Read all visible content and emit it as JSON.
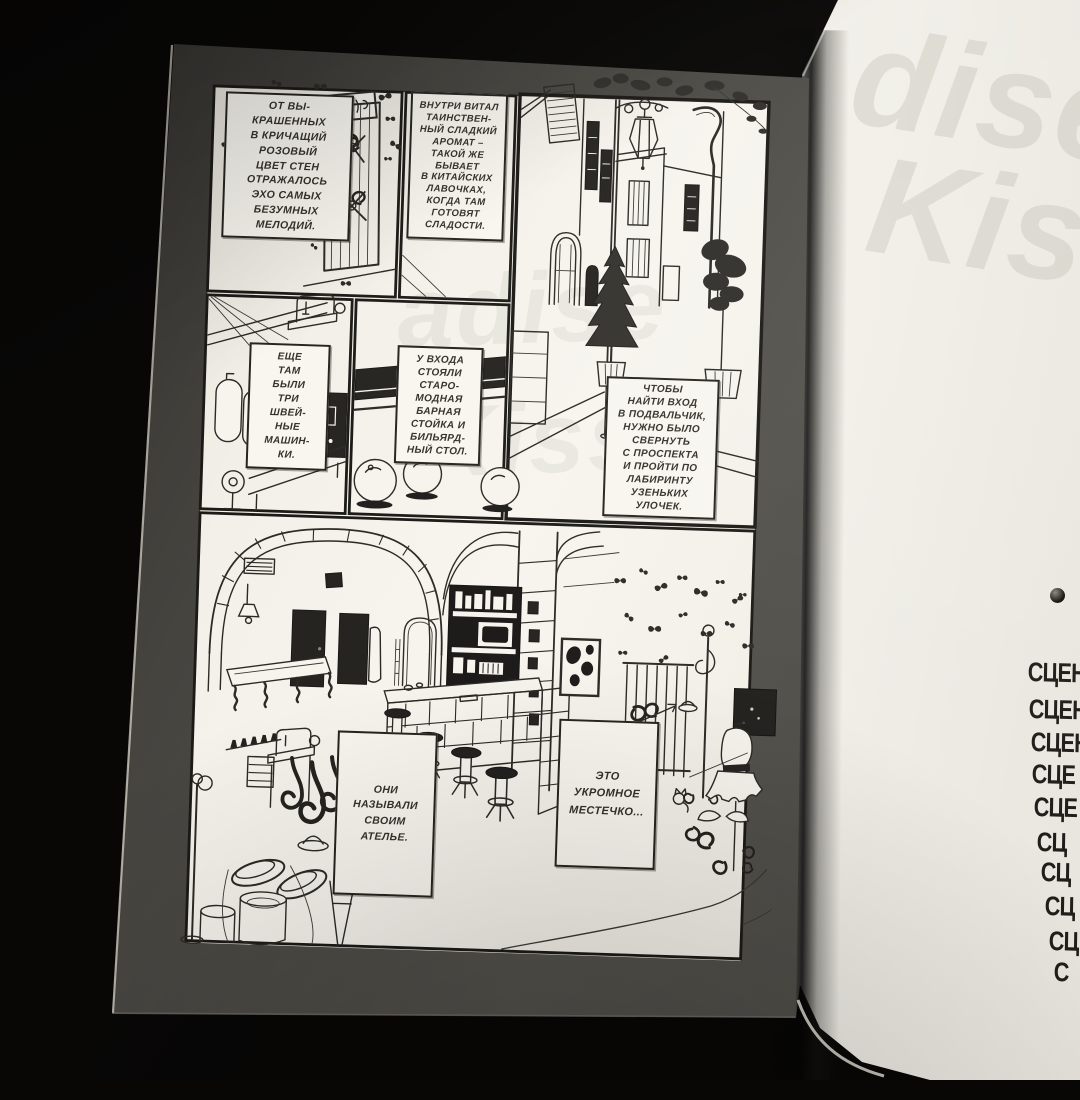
{
  "book": {
    "left_page": {
      "captions": [
        {
          "id": "caption-1",
          "text": "ОТ ВЫ-\nКРАШЕННЫХ\nВ КРИЧАЩИЙ\nРОЗОВЫЙ\nЦВЕТ СТЕН\nОТРАЖАЛОСЬ\nЭХО САМЫХ\nБЕЗУМНЫХ\nМЕЛОДИЙ."
        },
        {
          "id": "caption-2",
          "text": "ВНУТРИ ВИТАЛ\nТАИНСТВЕН-\nНЫЙ СЛАДКИЙ\nАРОМАТ –\nТАКОЙ ЖЕ\nБЫВАЕТ\nВ КИТАЙСКИХ\nЛАВОЧКАХ,\nКОГДА ТАМ\nГОТОВЯТ\nСЛАДОСТИ."
        },
        {
          "id": "caption-3",
          "text": "ЕЩЕ\nТАМ\nБЫЛИ\nТРИ\nШВЕЙ-\nНЫЕ\nМАШИН-\nКИ."
        },
        {
          "id": "caption-4",
          "text": "У ВХОДА\nСТОЯЛИ\nСТАРО-\nМОДНАЯ\nБАРНАЯ\nСТОЙКА И\nБИЛЬЯРД-\nНЫЙ СТОЛ."
        },
        {
          "id": "caption-5",
          "text": "ЧТОБЫ\nНАЙТИ ВХОД\nВ ПОДВАЛЬЧИК,\nНУЖНО БЫЛО\nСВЕРНУТЬ\nС ПРОСПЕКТА\nИ ПРОЙТИ ПО\nЛАБИРИНТУ\nУЗЕНЬКИХ\nУЛОЧЕК."
        },
        {
          "id": "caption-6",
          "text": "ОНИ\nНАЗЫВАЛИ\nСВОИМ\nАТЕЛЬЕ."
        },
        {
          "id": "caption-7",
          "text": "ЭТО\nУКРОМНОЕ\nМЕСТЕЧКО..."
        }
      ],
      "showthrough_lines": [
        "adise",
        "Kiss"
      ],
      "panels": [
        {
          "id": "panel-gate",
          "description": "wrought-iron gate with ornamental curls, shop sign, butterflies"
        },
        {
          "id": "panel-caption-aroma",
          "description": "caption box over blank wall"
        },
        {
          "id": "panel-street",
          "description": "narrow European street, ornate lamp bracket, shuttered windows, drainpipe, potted conifers"
        },
        {
          "id": "panel-sewing",
          "description": "sewing machines on tables, dress forms, threads"
        },
        {
          "id": "panel-counter-balls",
          "description": "dark counter and three billiard balls"
        },
        {
          "id": "panel-atelier",
          "description": "basement atelier: stone arches, bar counter with stools, bottle shelves, pool table, coat racks, dress form with tutu, butterflies on wall"
        }
      ]
    },
    "right_page": {
      "showthrough_lines": [
        "dise",
        "Kiss"
      ],
      "bullet_glyph": "●",
      "toc_fragments": [
        "СЦЕН",
        "СЦЕН",
        "СЦЕН",
        "СЦЕ",
        "СЦЕ",
        "СЦ",
        "СЦ",
        "СЦ",
        "СЦ",
        "С"
      ]
    },
    "colors": {
      "photo_background": "#080706",
      "paper": "#f6f4ed",
      "printed_margin": "#4c4a45",
      "ink": "#2b2a26",
      "toc_text": "#201e1b"
    }
  }
}
